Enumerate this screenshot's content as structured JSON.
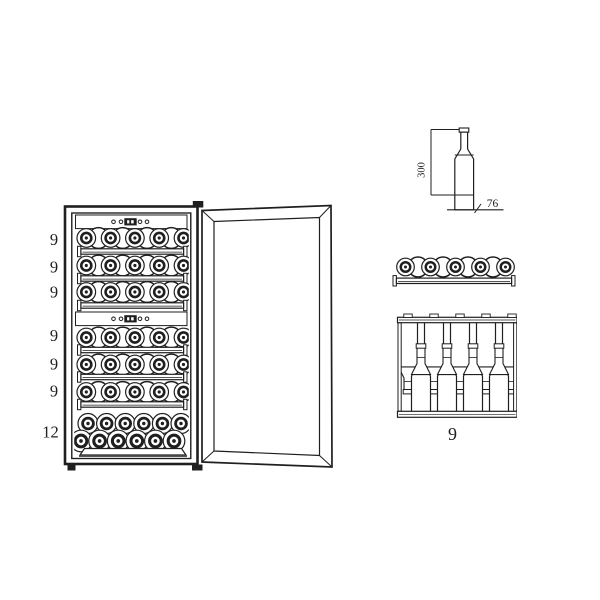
{
  "page": {
    "background": "#ffffff",
    "ink": "#1f1f1f"
  },
  "front_view": {
    "shelf_capacity_labels": [
      "9",
      "9",
      "9",
      "9",
      "9",
      "9"
    ],
    "bottom_capacity_label": "12",
    "shelf_count": 6,
    "bottles_per_shelf": 9,
    "bottom_rows_bottle_counts": [
      6,
      6
    ],
    "control_panel_count": 2
  },
  "bottle_dimensions": {
    "height_label": "300",
    "diameter_label": "76"
  },
  "shelf_front_view": {
    "bottle_count": 9
  },
  "shelf_top_view": {
    "capacity_label": "9",
    "necks_down_count": 5,
    "necks_up_count": 4
  }
}
